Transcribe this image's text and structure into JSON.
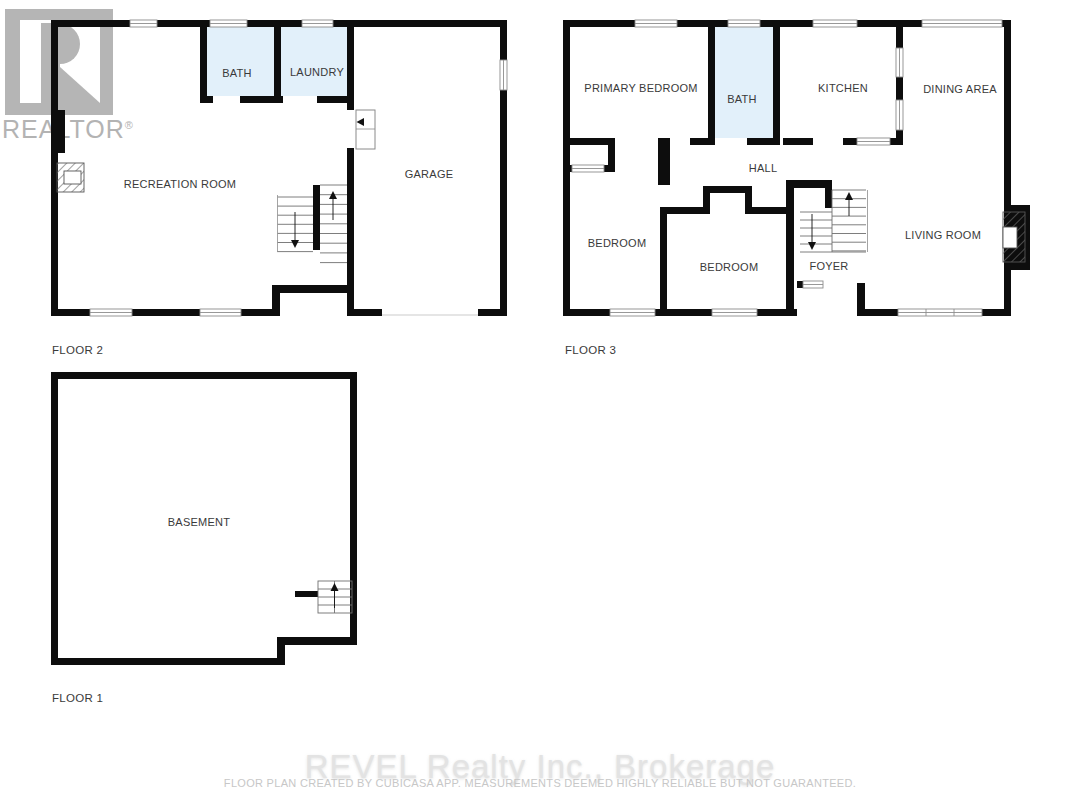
{
  "branding": {
    "realtor_logo_text": "REALTOR",
    "registered_mark": "\u00ae"
  },
  "floors": [
    {
      "id": "floor-2",
      "caption": "FLOOR 2",
      "rooms": [
        {
          "label": "BATH"
        },
        {
          "label": "LAUNDRY"
        },
        {
          "label": "RECREATION ROOM"
        },
        {
          "label": "GARAGE"
        }
      ]
    },
    {
      "id": "floor-3",
      "caption": "FLOOR 3",
      "rooms": [
        {
          "label": "PRIMARY BEDROOM"
        },
        {
          "label": "BATH"
        },
        {
          "label": "KITCHEN"
        },
        {
          "label": "DINING AREA"
        },
        {
          "label": "HALL"
        },
        {
          "label": "BEDROOM"
        },
        {
          "label": "BEDROOM"
        },
        {
          "label": "FOYER"
        },
        {
          "label": "LIVING ROOM"
        }
      ]
    },
    {
      "id": "floor-1",
      "caption": "FLOOR 1",
      "rooms": [
        {
          "label": "BASEMENT"
        }
      ]
    }
  ],
  "footer": {
    "brokerage": "REVEL Realty Inc., Brokerage",
    "disclaimer": "FLOOR PLAN CREATED BY CUBICASA APP. MEASUREMENTS DEEMED HIGHLY RELIABLE BUT NOT GUARANTEED."
  },
  "colors": {
    "wall": "#0d0d0d",
    "wet_room_fill": "#e2f0fa",
    "watermark_gray": "#b3b3b3",
    "label_text": "#3a3a3a"
  }
}
